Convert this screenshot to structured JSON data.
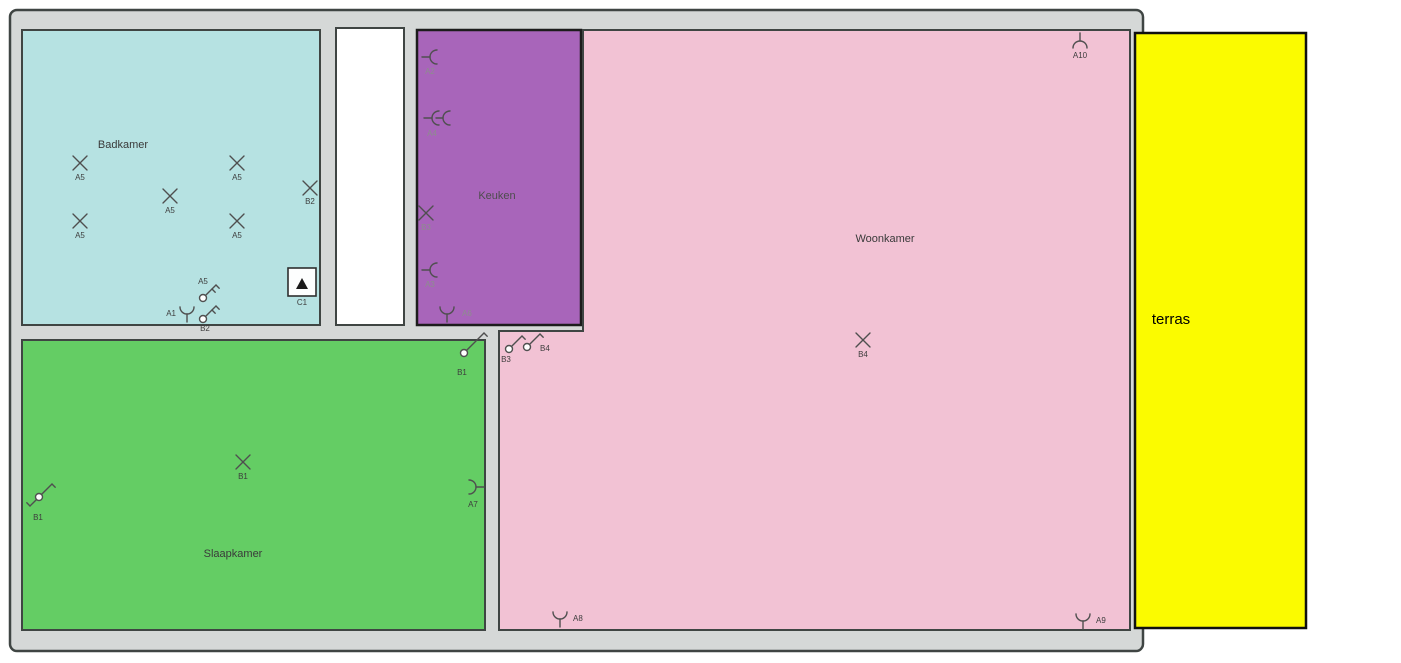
{
  "plan": {
    "background": "#ffffff",
    "wall_fill": "#d5d8d7",
    "wall_stroke": "#3f4543",
    "symbol_stroke": "#4f4f4f",
    "symbol_label_color": "#3d3d3d",
    "keuken_label_color": "#8d8d8d"
  },
  "rooms": [
    {
      "id": "badkamer",
      "label": "Badkamer",
      "color": "#b6e2e2",
      "shape": "rect",
      "x": 22,
      "y": 30,
      "w": 298,
      "h": 295
    },
    {
      "id": "hal",
      "label": "",
      "color": "#ffffff",
      "shape": "rect",
      "x": 336,
      "y": 28,
      "w": 68,
      "h": 297
    },
    {
      "id": "keuken",
      "label": "Keuken",
      "color": "#a865ba",
      "shape": "rect",
      "x": 417,
      "y": 30,
      "w": 164,
      "h": 295,
      "stroke": "#1c1c1c",
      "stroke_width": 2.5
    },
    {
      "id": "woonkamer",
      "label": "Woonkamer",
      "color": "#f2c2d4",
      "shape": "polygon",
      "points": "583,30 1130,30 1130,630 499,630 499,331 583,331"
    },
    {
      "id": "slaapkamer",
      "label": "Slaapkamer",
      "color": "#64cd64",
      "shape": "rect",
      "x": 22,
      "y": 340,
      "w": 463,
      "h": 290
    },
    {
      "id": "terras",
      "label": "terras",
      "color": "#fbfb00",
      "shape": "rect",
      "x": 1135,
      "y": 33,
      "w": 171,
      "h": 595,
      "stroke": "#101010",
      "stroke_width": 2.5
    }
  ],
  "symbols": [
    {
      "type": "light",
      "label": "A5",
      "x": 80,
      "y": 163
    },
    {
      "type": "light",
      "label": "A5",
      "x": 237,
      "y": 163
    },
    {
      "type": "light",
      "label": "A5",
      "x": 170,
      "y": 196
    },
    {
      "type": "light",
      "label": "A5",
      "x": 80,
      "y": 221
    },
    {
      "type": "light",
      "label": "A5",
      "x": 237,
      "y": 221
    },
    {
      "type": "light",
      "label": "B2",
      "x": 310,
      "y": 188,
      "lx": 310,
      "ly": 204
    },
    {
      "type": "switch",
      "label": "A5",
      "x": 203,
      "y": 298,
      "double": true,
      "lx": 203,
      "ly": 284
    },
    {
      "type": "switch",
      "label": "B2",
      "x": 203,
      "y": 319,
      "double": true,
      "lx": 205,
      "ly": 331
    },
    {
      "type": "socket",
      "label": "A1",
      "x": 187,
      "y": 312,
      "rot": 0,
      "lx": 176,
      "ly": 316,
      "anchor": "end"
    },
    {
      "type": "box",
      "label": "C1",
      "x": 302,
      "y": 282,
      "lx": 302,
      "ly": 305
    },
    {
      "type": "socket",
      "label": "A2",
      "x": 432,
      "y": 57,
      "rot": 90,
      "lx": 430,
      "ly": 74,
      "label_color": "#8d8d8d"
    },
    {
      "type": "socket2",
      "label": "A4",
      "x": 434,
      "y": 118,
      "rot": 90,
      "lx": 432,
      "ly": 136,
      "label_color": "#8d8d8d"
    },
    {
      "type": "light",
      "label": "B3",
      "x": 426,
      "y": 213,
      "lx": 426,
      "ly": 230,
      "label_color": "#8d8d8d"
    },
    {
      "type": "socket",
      "label": "A3",
      "x": 432,
      "y": 270,
      "rot": 90,
      "lx": 430,
      "ly": 287,
      "label_color": "#8d8d8d"
    },
    {
      "type": "socket",
      "label": "A6",
      "x": 447,
      "y": 312,
      "rot": 0,
      "lx": 462,
      "ly": 316,
      "anchor": "start",
      "label_color": "#8d8d8d"
    },
    {
      "type": "socket",
      "label": "A10",
      "x": 1080,
      "y": 43,
      "rot": 180,
      "lx": 1080,
      "ly": 58
    },
    {
      "type": "switch",
      "label": "B3",
      "x": 509,
      "y": 349,
      "lx": 506,
      "ly": 362
    },
    {
      "type": "switch",
      "label": "B4",
      "x": 527,
      "y": 347,
      "lx": 540,
      "ly": 351,
      "anchor": "start"
    },
    {
      "type": "light",
      "label": "B4",
      "x": 863,
      "y": 340,
      "lx": 863,
      "ly": 357
    },
    {
      "type": "socket",
      "label": "A8",
      "x": 560,
      "y": 617,
      "rot": 0,
      "lx": 573,
      "ly": 621,
      "anchor": "start"
    },
    {
      "type": "socket",
      "label": "A9",
      "x": 1083,
      "y": 619,
      "rot": 0,
      "lx": 1096,
      "ly": 623,
      "anchor": "start"
    },
    {
      "type": "switch",
      "label": "B1",
      "x": 464,
      "y": 353,
      "len": 20,
      "lx": 462,
      "ly": 375
    },
    {
      "type": "light",
      "label": "B1",
      "x": 243,
      "y": 462,
      "lx": 243,
      "ly": 479
    },
    {
      "type": "switch2",
      "label": "B1",
      "x": 39,
      "y": 497,
      "lx": 38,
      "ly": 520
    },
    {
      "type": "socket",
      "label": "A7",
      "x": 474,
      "y": 487,
      "rot": -90,
      "lx": 473,
      "ly": 507
    }
  ],
  "room_labels": {
    "badkamer": "Badkamer",
    "keuken": "Keuken",
    "woonkamer": "Woonkamer",
    "slaapkamer": "Slaapkamer",
    "terras": "terras"
  }
}
